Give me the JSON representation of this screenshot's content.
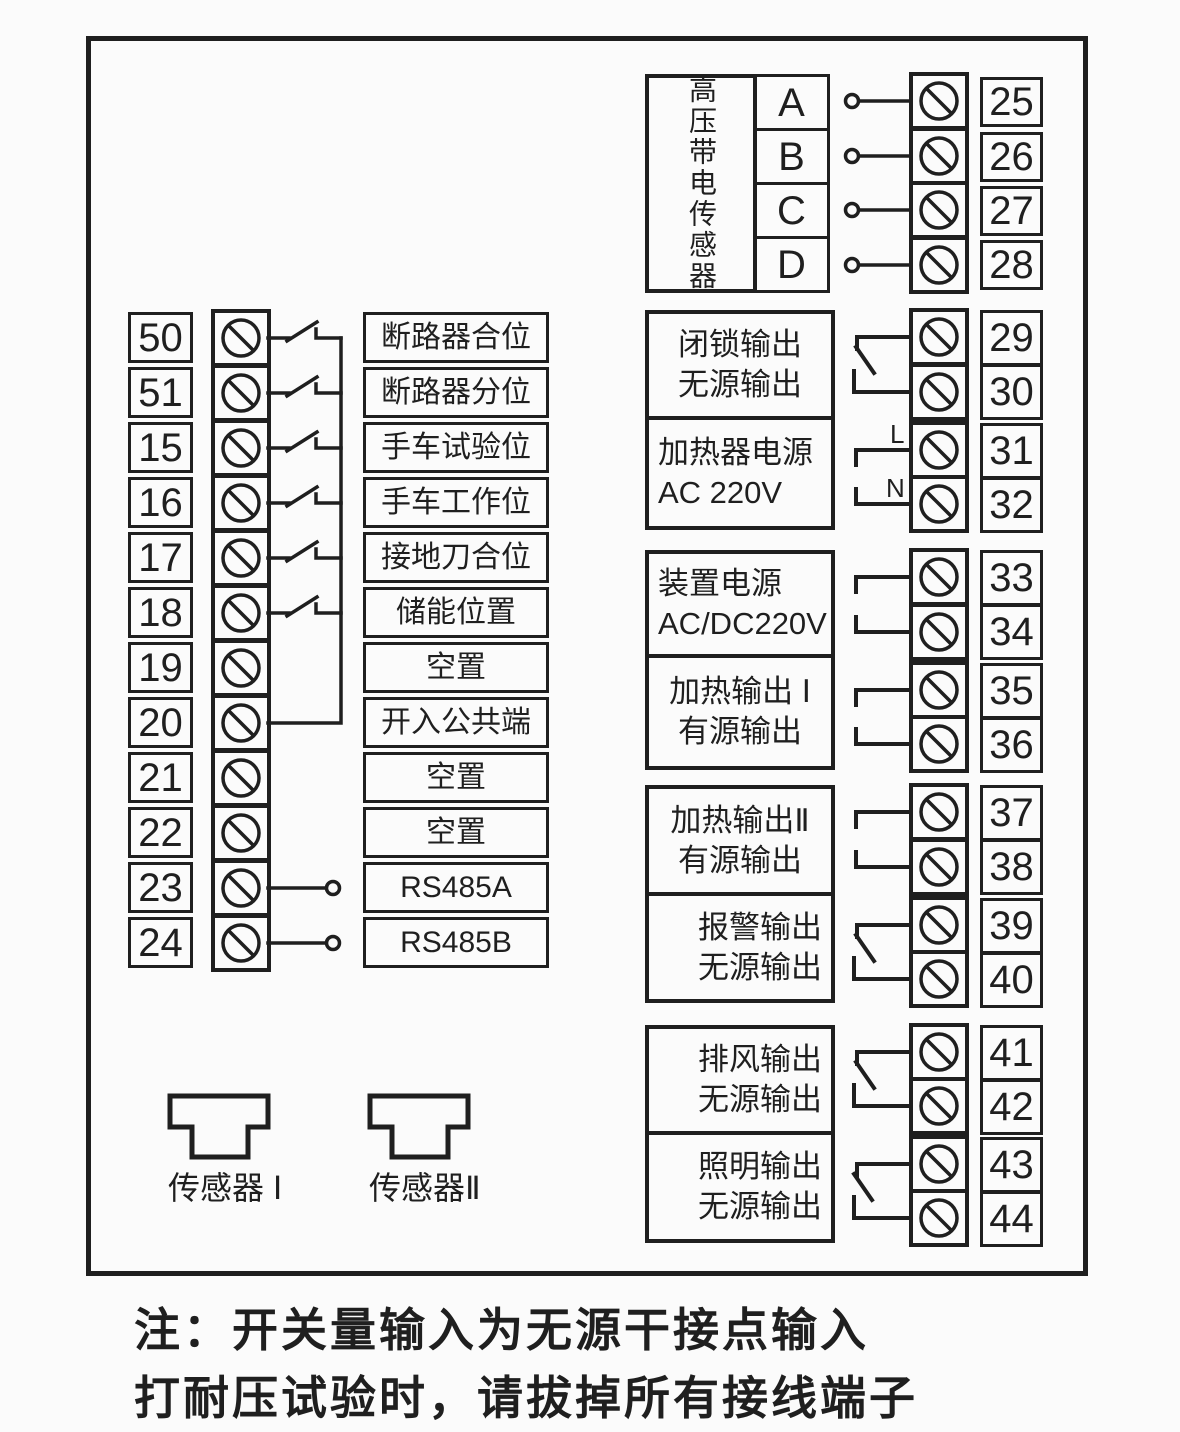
{
  "hv_sensor_block": {
    "title": "高压带电传感器",
    "rows": [
      {
        "phase": "A",
        "terminal": "25"
      },
      {
        "phase": "B",
        "terminal": "26"
      },
      {
        "phase": "C",
        "terminal": "27"
      },
      {
        "phase": "D",
        "terminal": "28"
      }
    ]
  },
  "input_terminals": [
    {
      "number": "50",
      "label": "断路器合位"
    },
    {
      "number": "51",
      "label": "断路器分位"
    },
    {
      "number": "15",
      "label": "手车试验位"
    },
    {
      "number": "16",
      "label": "手车工作位"
    },
    {
      "number": "17",
      "label": "接地刀合位"
    },
    {
      "number": "18",
      "label": "储能位置"
    },
    {
      "number": "19",
      "label": "空置"
    },
    {
      "number": "20",
      "label": "开入公共端"
    },
    {
      "number": "21",
      "label": "空置"
    },
    {
      "number": "22",
      "label": "空置"
    },
    {
      "number": "23",
      "label": "RS485A"
    },
    {
      "number": "24",
      "label": "RS485B"
    }
  ],
  "output_blocks": [
    {
      "line1": "闭锁输出",
      "line2": "无源输出",
      "terminal1": "29",
      "terminal2": "30"
    },
    {
      "line1": "加热器电源",
      "line2": "AC 220V",
      "terminal1": "31",
      "terminal2": "32",
      "mark1": "L",
      "mark2": "N"
    },
    {
      "line1": "装置电源",
      "line2": "AC/DC220V",
      "terminal1": "33",
      "terminal2": "34"
    },
    {
      "line1": "加热输出 Ⅰ",
      "line2": "有源输出",
      "terminal1": "35",
      "terminal2": "36"
    },
    {
      "line1": "加热输出Ⅱ",
      "line2": "有源输出",
      "terminal1": "37",
      "terminal2": "38"
    },
    {
      "line1": "报警输出",
      "line2": "无源输出",
      "terminal1": "39",
      "terminal2": "40"
    },
    {
      "line1": "排风输出",
      "line2": "无源输出",
      "terminal1": "41",
      "terminal2": "42"
    },
    {
      "line1": "照明输出",
      "line2": "无源输出",
      "terminal1": "43",
      "terminal2": "44"
    }
  ],
  "sensor_connectors": [
    {
      "label": "传感器 Ⅰ"
    },
    {
      "label": "传感器Ⅱ"
    }
  ],
  "note": {
    "line1": "注：开关量输入为无源干接点输入",
    "line2": "打耐压试验时，请拔掉所有接线端子"
  },
  "colors": {
    "line": "#1f1f1f",
    "background": "#fbfbfb"
  }
}
